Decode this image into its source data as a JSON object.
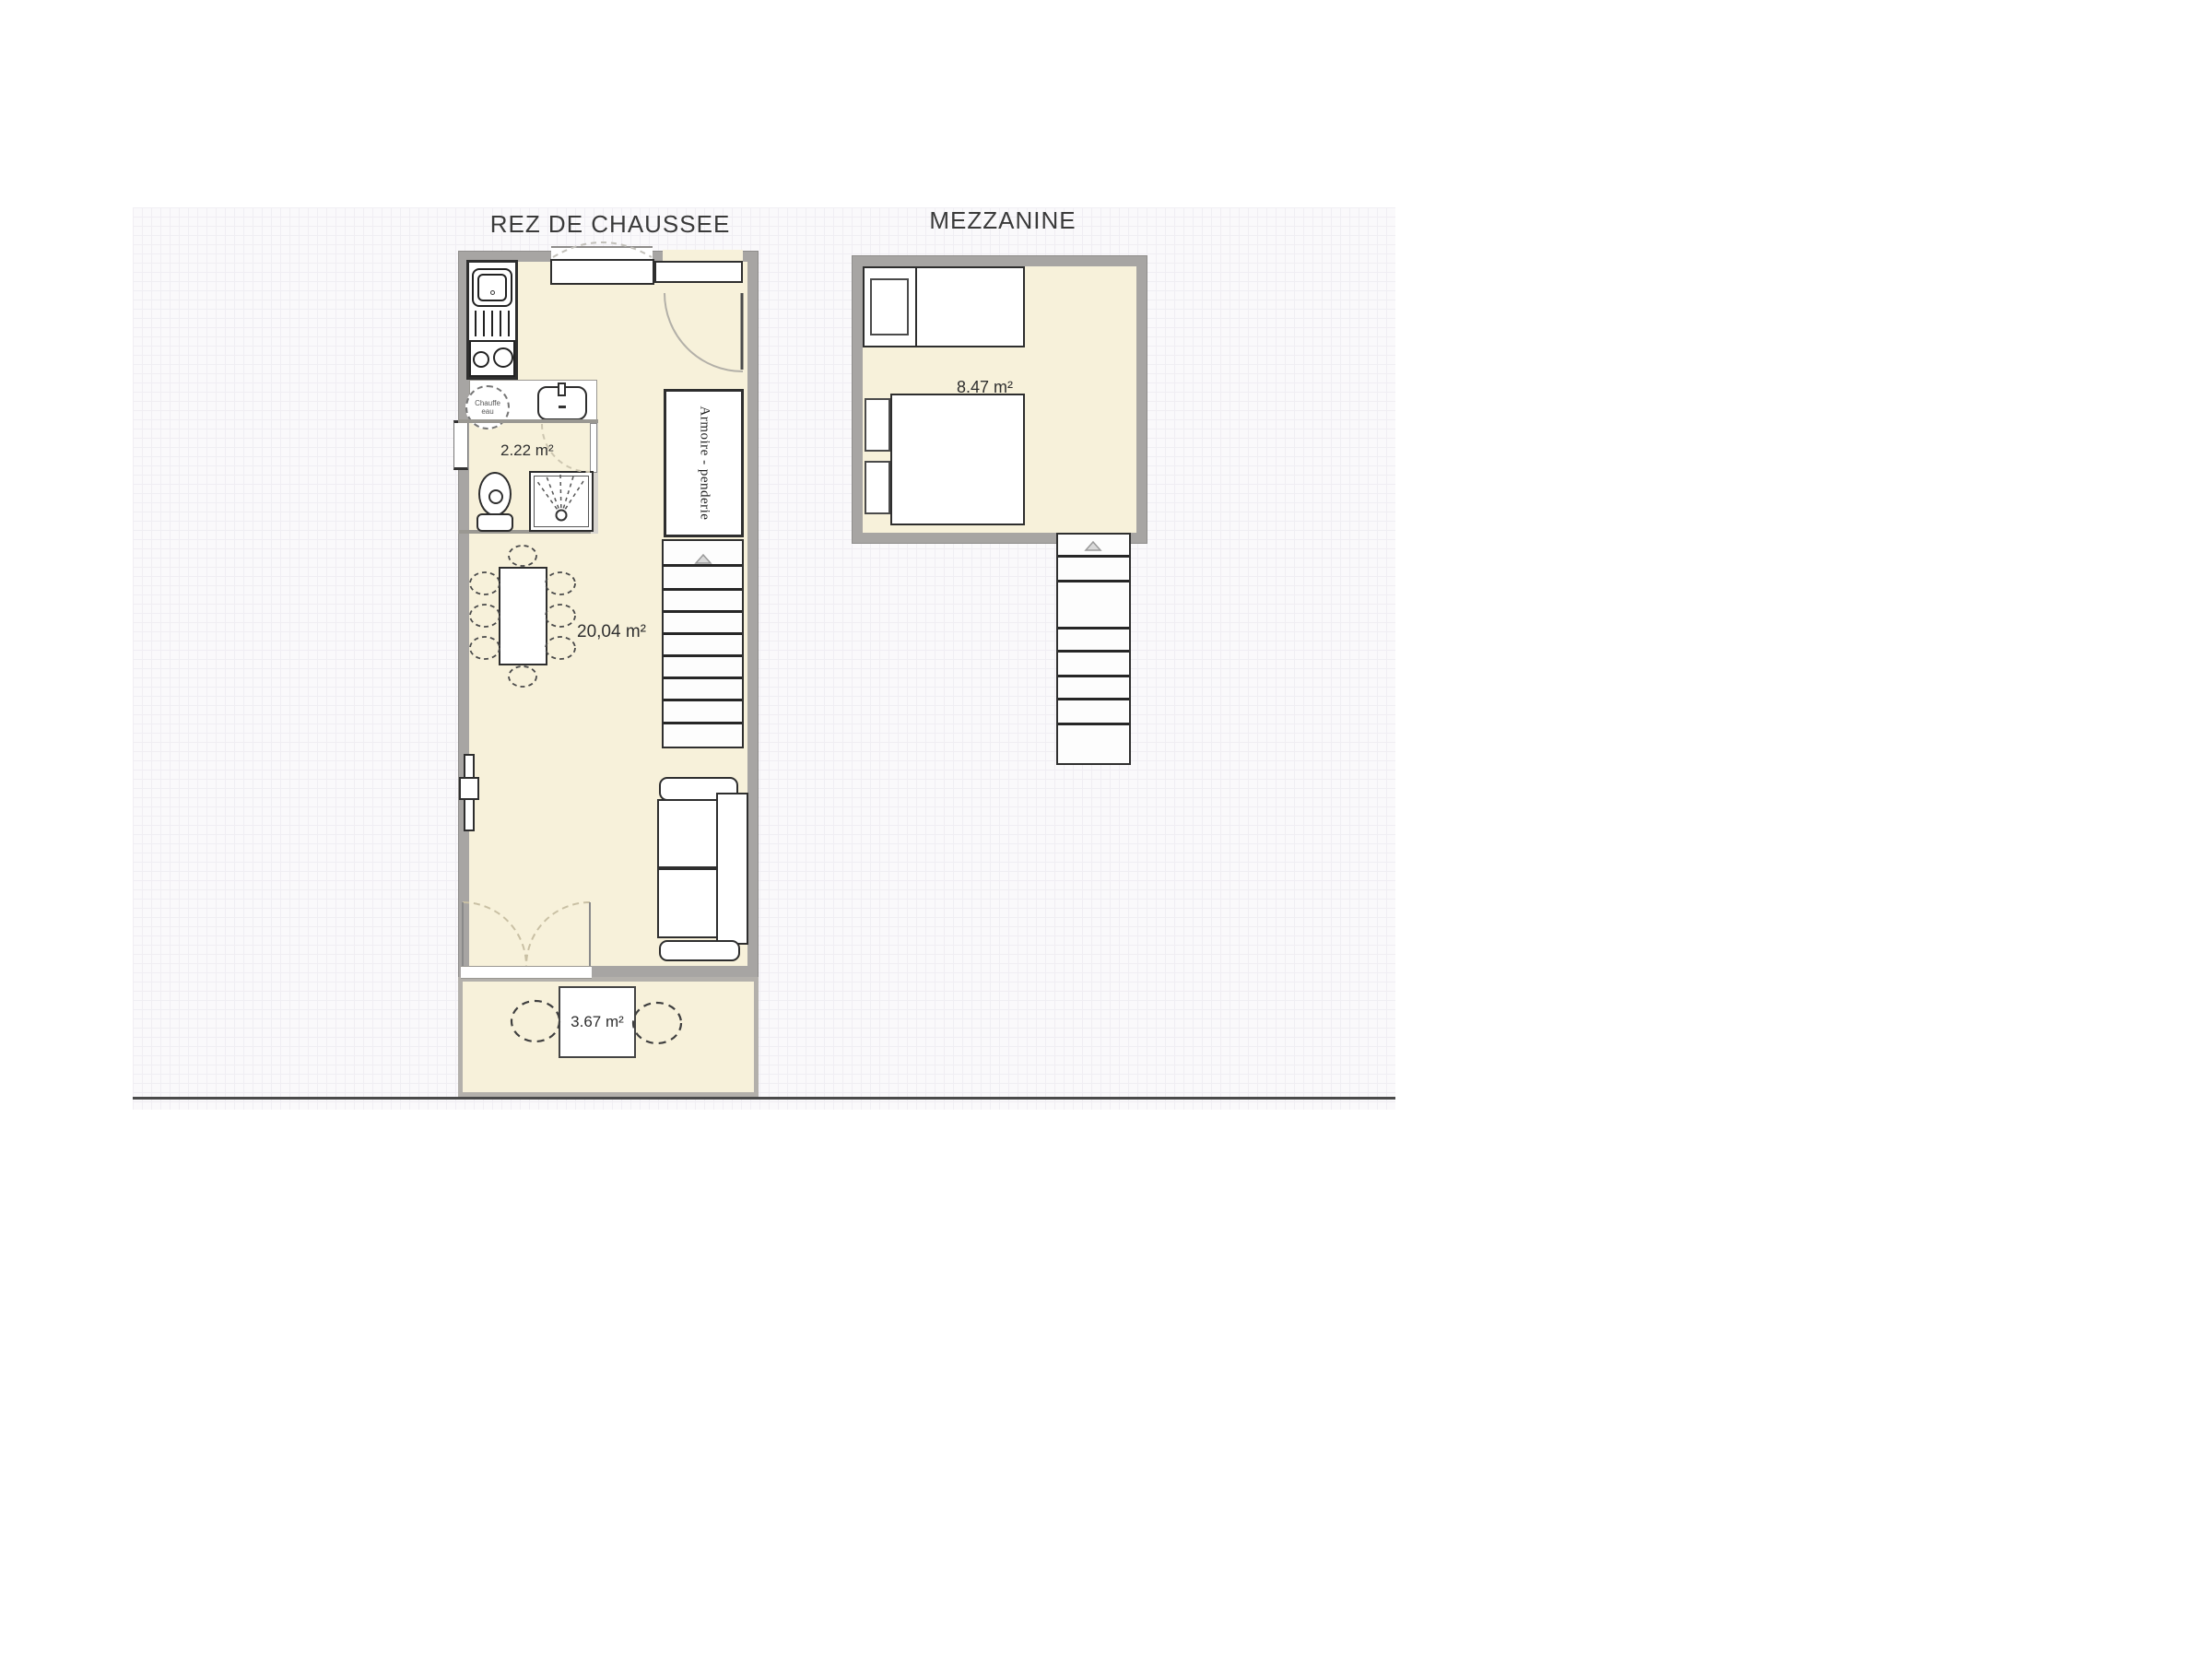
{
  "colors": {
    "floor": "#f7f1da",
    "wall": "#a7a5a3",
    "outline": "#2e2e2e",
    "grid_background": "#faf9fb",
    "base_line": "#4a4a4a"
  },
  "plans": {
    "ground_floor": {
      "title": "REZ DE CHAUSSEE",
      "living_area_label": "20,04 m²",
      "bathroom_area_label": "2.22 m²",
      "terrace_area_label": "3.67 m²",
      "wardrobe_label": "Armoire - penderie",
      "water_heater_line1": "Chauffe",
      "water_heater_line2": "eau"
    },
    "mezzanine": {
      "title": "MEZZANINE",
      "area_label": "8.47 m²"
    }
  }
}
